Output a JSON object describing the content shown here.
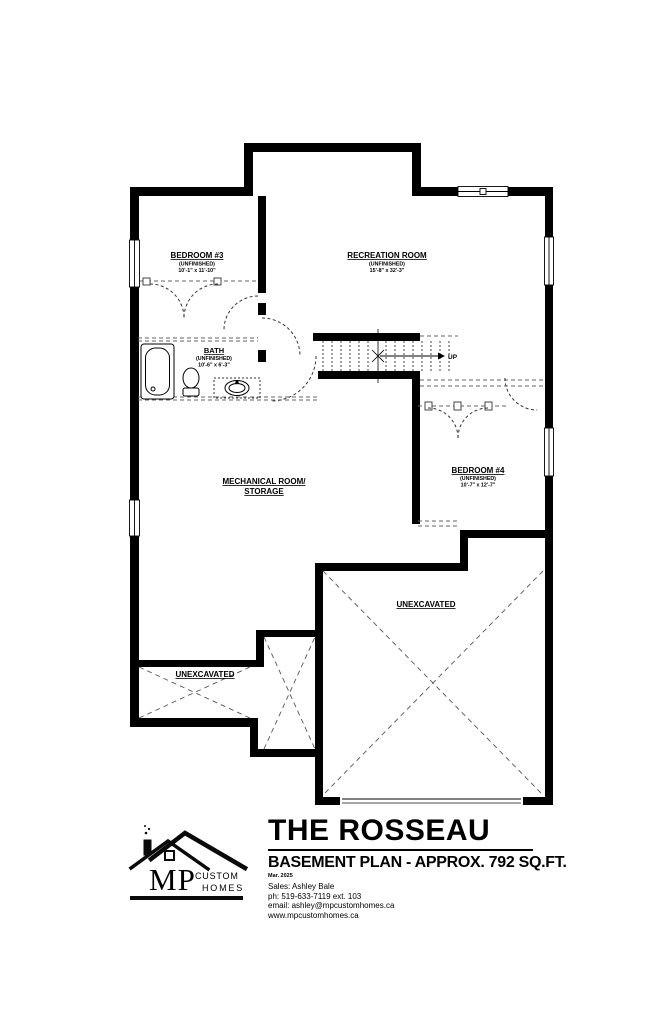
{
  "document": {
    "title": "THE ROSSEAU",
    "subtitle": "BASEMENT PLAN - APPROX. 792 SQ.FT.",
    "date": "Mar. 2025",
    "contact": {
      "sales": "Sales: Ashley Bale",
      "phone": "ph: 519-633-7119 ext. 103",
      "email": "email: ashley@mpcustomhomes.ca",
      "website": "www.mpcustomhomes.ca"
    },
    "logo": {
      "monogram": "MP",
      "word1": "CUSTOM",
      "word2": "HOMES"
    }
  },
  "plan": {
    "rooms": {
      "bedroom3": {
        "name": "BEDROOM #3",
        "status": "(UNFINISHED)",
        "dims": "10'-1\" x 11'-10\""
      },
      "recreation": {
        "name": "RECREATION ROOM",
        "status": "(UNFINISHED)",
        "dims": "15'-8\" x 32'-3\""
      },
      "bath": {
        "name": "BATH",
        "status": "(UNFINISHED)",
        "dims": "10'-6\" x 6'-3\""
      },
      "mechanical": {
        "name": "MECHANICAL ROOM/",
        "name2": "STORAGE"
      },
      "bedroom4": {
        "name": "BEDROOM #4",
        "status": "(UNFINISHED)",
        "dims": "10'-7\" x 12'-7\""
      }
    },
    "labels": {
      "unexcavated": "UNEXCAVATED",
      "up": "UP"
    },
    "colors": {
      "wall": "#000000",
      "dashed": "#555555",
      "background": "#ffffff"
    }
  }
}
